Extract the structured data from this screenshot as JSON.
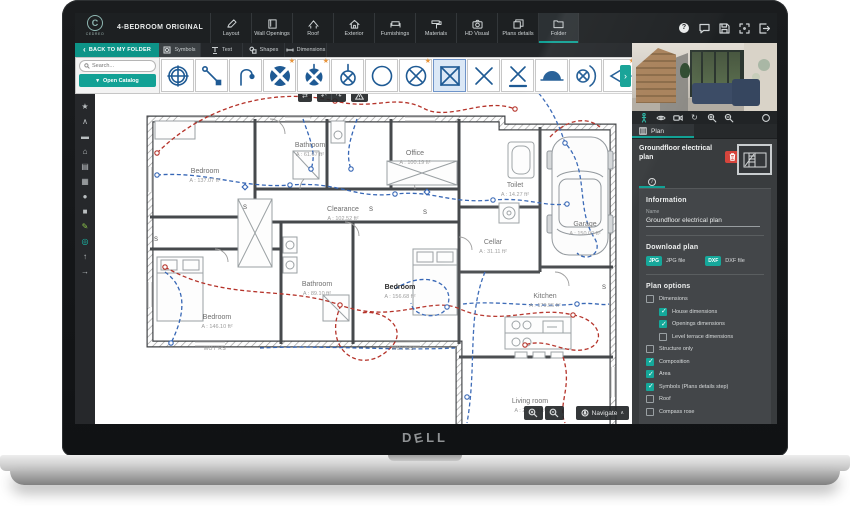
{
  "laptop": {
    "brand_letters": [
      "D",
      "E",
      "L",
      "L"
    ]
  },
  "app": {
    "logo_text": "CEDREO",
    "logo_initial": "C",
    "title": "4-BEDROOM ORIGINAL",
    "top_tabs": [
      {
        "label": "Layout",
        "icon": "pencil-icon",
        "active": false
      },
      {
        "label": "Wall Openings",
        "icon": "door-icon",
        "active": false
      },
      {
        "label": "Roof",
        "icon": "roof-icon",
        "active": false
      },
      {
        "label": "Exterior",
        "icon": "house-icon",
        "active": false
      },
      {
        "label": "Furnishings",
        "icon": "sofa-icon",
        "active": false
      },
      {
        "label": "Materials",
        "icon": "paint-roller-icon",
        "active": false
      },
      {
        "label": "HD Visual",
        "icon": "camera-icon",
        "active": false
      },
      {
        "label": "Plans details",
        "icon": "sheets-icon",
        "active": false
      },
      {
        "label": "Folder",
        "icon": "folder-icon",
        "active": true
      }
    ],
    "top_right_icons": [
      "help-icon",
      "chat-icon",
      "save-icon",
      "fullscreen-icon",
      "exit-icon"
    ]
  },
  "toolbar": {
    "back_label": "BACK TO MY FOLDER",
    "tabs": [
      {
        "label": "Symbols",
        "active": true
      },
      {
        "label": "Text",
        "active": false
      },
      {
        "label": "Shapes",
        "active": false
      },
      {
        "label": "Dimensions",
        "active": false
      }
    ]
  },
  "catalog": {
    "search_placeholder": "Search...",
    "open_button": "Open Catalog"
  },
  "symbols": {
    "tiles": [
      {
        "name": "target-light",
        "starred": false,
        "selected": false
      },
      {
        "name": "wiring-run",
        "starred": false,
        "selected": false
      },
      {
        "name": "arc-cable",
        "starred": false,
        "selected": false
      },
      {
        "name": "junction-quad-large",
        "starred": true,
        "selected": false
      },
      {
        "name": "junction-quad-small",
        "starred": true,
        "selected": false
      },
      {
        "name": "ceiling-lamp-stem",
        "starred": false,
        "selected": false
      },
      {
        "name": "outlet-circle",
        "starred": false,
        "selected": false
      },
      {
        "name": "recessed-light",
        "starred": true,
        "selected": false
      },
      {
        "name": "box-cross",
        "starred": false,
        "selected": true
      },
      {
        "name": "cross-marker",
        "starred": false,
        "selected": false
      },
      {
        "name": "cross-underlined",
        "starred": false,
        "selected": false
      },
      {
        "name": "half-dome-light",
        "starred": false,
        "selected": false
      },
      {
        "name": "wall-lamp",
        "starred": false,
        "selected": false
      },
      {
        "name": "spotlight",
        "starred": true,
        "selected": false
      }
    ]
  },
  "sidebar": {
    "items": [
      {
        "name": "favorites",
        "glyph": "★"
      },
      {
        "name": "collapse",
        "glyph": "∧"
      },
      {
        "name": "seating",
        "glyph": "▬"
      },
      {
        "name": "exterior",
        "glyph": "⌂"
      },
      {
        "name": "storage",
        "glyph": "▤"
      },
      {
        "name": "kitchen-furniture",
        "glyph": "▦"
      },
      {
        "name": "decoration",
        "glyph": "●"
      },
      {
        "name": "appliances",
        "glyph": "■"
      },
      {
        "name": "draw",
        "glyph": "✎"
      },
      {
        "name": "electrical",
        "glyph": "◎"
      },
      {
        "name": "lighting",
        "glyph": "↑"
      },
      {
        "name": "pointer",
        "glyph": "→"
      }
    ]
  },
  "icons": {
    "swap": "⇄",
    "undo": "↶",
    "redo": "↷",
    "scroll_right": "›",
    "chevron_down": "▾",
    "chevron_up": "∧",
    "back_chevron": "‹",
    "star": "★",
    "refresh": "↻"
  },
  "plan": {
    "rooms": [
      {
        "name": "Bedroom",
        "area": "A : 137.07 ft²"
      },
      {
        "name": "Bathroom",
        "area": "A : 61.67 ft²"
      },
      {
        "name": "Office",
        "area": "A : 100.19 ft²"
      },
      {
        "name": "Toilet",
        "area": "A : 14.27 ft²"
      },
      {
        "name": "Clearance",
        "area": "A : 102.52 ft²"
      },
      {
        "name": "Cellar",
        "area": "A : 31.11 ft²"
      },
      {
        "name": "Garage",
        "area": "A : 150.00 ft²"
      },
      {
        "name": "Bathroom",
        "area": "A : 89.10 ft²"
      },
      {
        "name": "Bedroom",
        "area": "A : 146.10 ft²"
      },
      {
        "name": "Bedroom",
        "area": "A : 156.68 ft²"
      },
      {
        "name": "Kitchen",
        "area": "A : 179.55 ft²"
      },
      {
        "name": "Living room",
        "area": "A : 279.09 ft²"
      }
    ],
    "wall_labels": [
      "MOT RS",
      "MOT RS"
    ],
    "switch_label": "S"
  },
  "viewport": {
    "navigate_label": "Navigate"
  },
  "right_panel": {
    "plan_tab": "Plan",
    "plan_title": "Groundfloor electrical plan",
    "information": {
      "heading": "Information",
      "name_label": "Name",
      "name_value": "Groundfloor electrical plan"
    },
    "download": {
      "heading": "Download plan",
      "items": [
        {
          "badge": "JPG",
          "label": "JPG file"
        },
        {
          "badge": "DXF",
          "label": "DXF file"
        }
      ]
    },
    "options": {
      "heading": "Plan options",
      "items": [
        {
          "label": "Dimensions",
          "checked": false,
          "indent": 0
        },
        {
          "label": "House dimensions",
          "checked": true,
          "indent": 1
        },
        {
          "label": "Openings dimensions",
          "checked": true,
          "indent": 1
        },
        {
          "label": "Level terrace dimensions",
          "checked": false,
          "indent": 1
        },
        {
          "label": "Structure only",
          "checked": false,
          "indent": 0
        },
        {
          "label": "Composition",
          "checked": true,
          "indent": 0
        },
        {
          "label": "Area",
          "checked": true,
          "indent": 0
        },
        {
          "label": "Symbols (Plans details step)",
          "checked": true,
          "indent": 0
        },
        {
          "label": "Roof",
          "checked": false,
          "indent": 0
        },
        {
          "label": "Compass rose",
          "checked": false,
          "indent": 0
        }
      ]
    }
  },
  "colors": {
    "accent": "#12a195",
    "symbol_blue": "#1e5a94",
    "circuit_red": "#b5332a",
    "circuit_blue": "#3666b5",
    "delete_red": "#d6453c",
    "star_orange": "#e8953c"
  }
}
